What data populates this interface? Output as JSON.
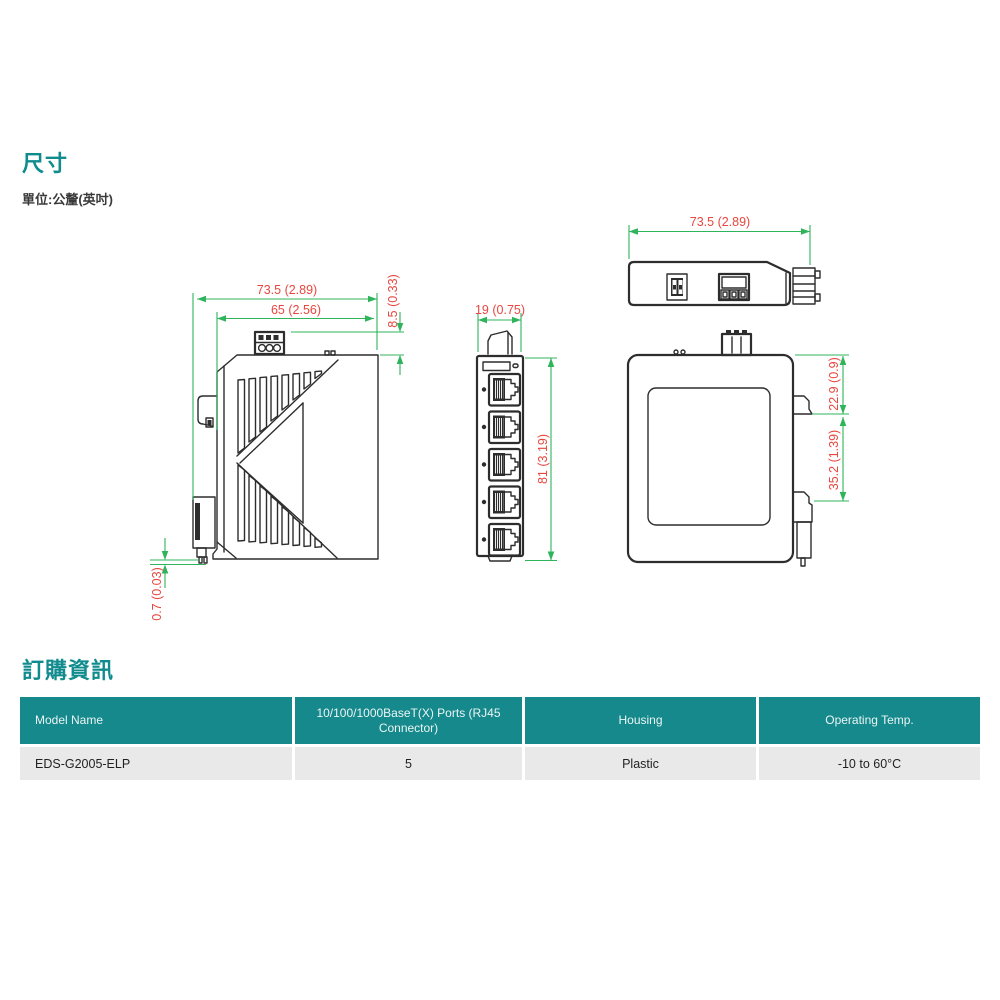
{
  "page": {
    "section_dimensions_title": "尺寸",
    "unit_note": "單位:公釐(英吋)",
    "section_ordering_title": "訂購資訊"
  },
  "drawings": {
    "side_view": {
      "width_outer": "73.5 (2.89)",
      "width_inner": "65 (2.56)",
      "terminal_height": "8.5 (0.33)",
      "bottom_gap": "0.7 (0.03)"
    },
    "front_view": {
      "width": "19 (0.75)",
      "height": "81 (3.19)"
    },
    "top_view": {
      "width": "73.5 (2.89)"
    },
    "rear_view": {
      "din_clip_offset": "22.9 (0.9)",
      "din_clip_span": "35.2 (1.39)"
    }
  },
  "colors": {
    "accent_teal": "#15898b",
    "dimension_text": "#e8463e",
    "dimension_lines": "#2fb45c"
  },
  "ordering_table": {
    "headers": [
      "Model Name",
      "10/100/1000BaseT(X) Ports (RJ45 Connector)",
      "Housing",
      "Operating Temp."
    ],
    "rows": [
      [
        "EDS-G2005-ELP",
        "5",
        "Plastic",
        "-10 to 60°C"
      ]
    ]
  }
}
